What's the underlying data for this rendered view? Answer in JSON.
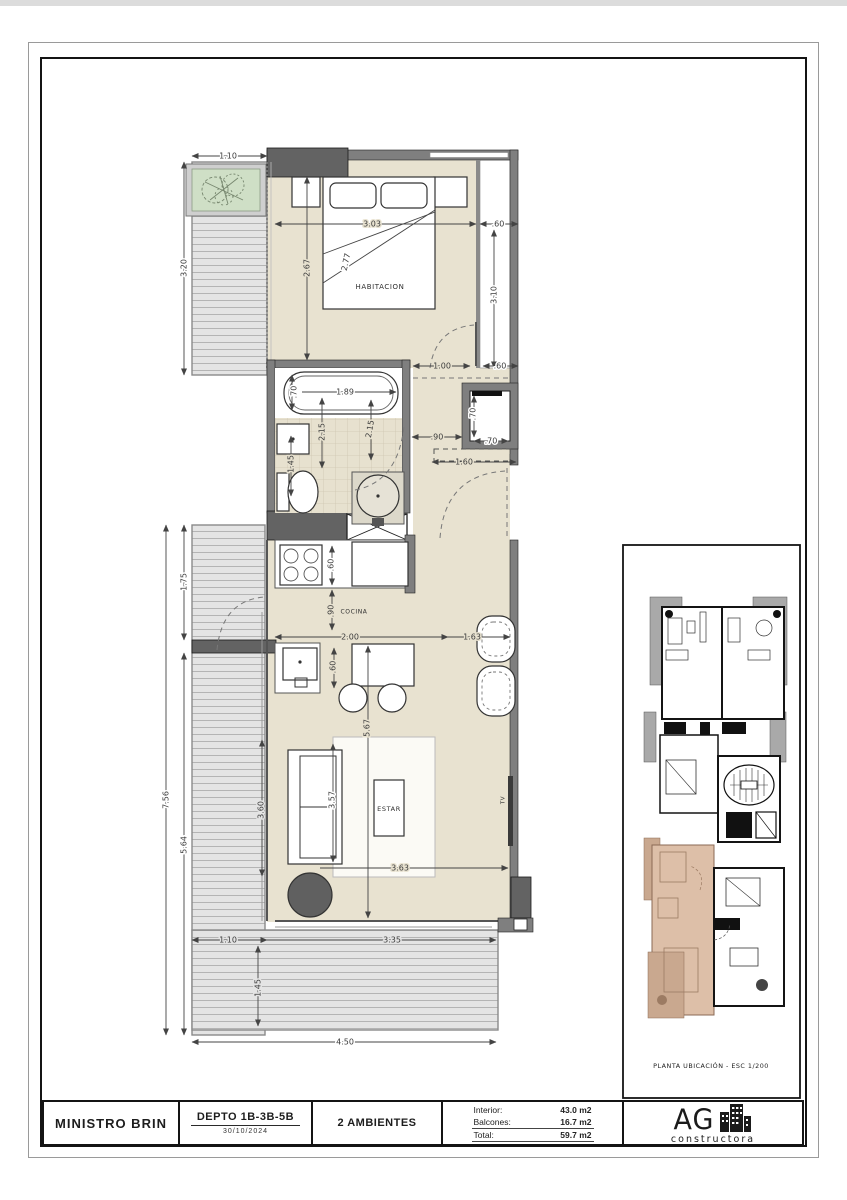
{
  "title_block": {
    "project": "MINISTRO BRIN",
    "unit": "DEPTO 1B-3B-5B",
    "date": "30/10/2024",
    "rooms": "2 AMBIENTES",
    "areas": {
      "interior_label": "Interior:",
      "interior_value": "43.0 m2",
      "balconies_label": "Balcones:",
      "balconies_value": "16.7 m2",
      "total_label": "Total:",
      "total_value": "59.7 m2"
    },
    "logo": {
      "name": "AG",
      "subtitle": "constructora"
    }
  },
  "location_panel": {
    "caption": "PLANTA UBICACIÓN - ESC 1/200"
  },
  "plan": {
    "rooms": {
      "bedroom": "HABITACION",
      "kitchen": "COCINA",
      "living": "ESTAR",
      "tv": "TV"
    },
    "dims": {
      "balcony_top_w": "1.10",
      "balcony_top_h": "3.20",
      "bed_w": "3.03",
      "closet_w": ".60",
      "bed_l": "2.67",
      "bed_diag": "2.77",
      "closet_h": "3.10",
      "door": "1.00",
      "entry_r": ".60",
      "tub_w": ".70",
      "tub_l": "1.89",
      "shaft_v": ".70",
      "shaft_h": ".70",
      "bath_v1": "2.15",
      "bath_v2": "2.15",
      "bath_w": "1.45",
      "hall": ".90",
      "entry": "1.60",
      "balc_mid": "1.75",
      "cook": ".60",
      "kitchen_d": ".90",
      "kitchen_w": "2.00",
      "win": "1.63",
      "sink": ".60",
      "living_h": "5.67",
      "balc_total": "7.56",
      "balc_low": "5.64",
      "balc_in": "3.60",
      "sofa": "3.57",
      "living_w": "3.63",
      "deck_bl": "1.10",
      "deck_bw": "3.35",
      "deck_bh": "1.45",
      "deck_total": "4.50"
    }
  }
}
